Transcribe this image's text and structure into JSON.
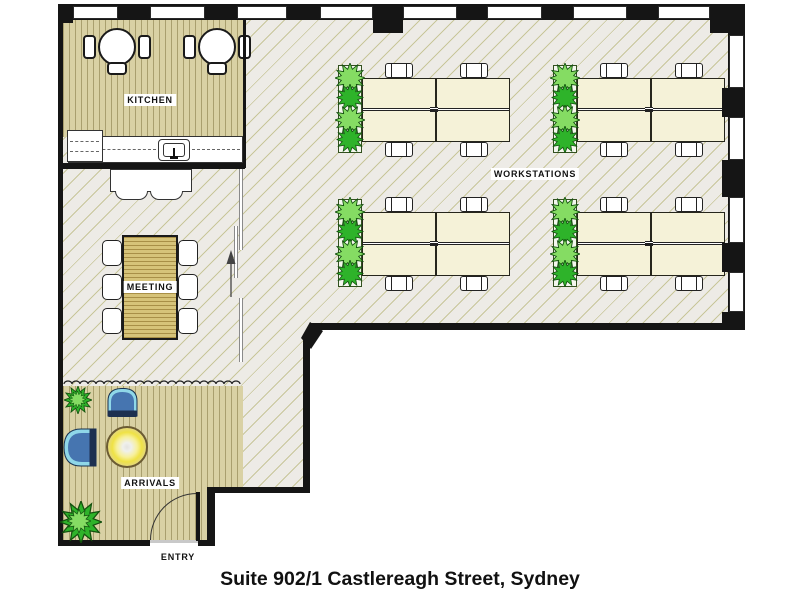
{
  "plan": {
    "caption": "Suite 902/1 Castlereagh Street, Sydney",
    "labels": {
      "kitchen": "KITCHEN",
      "meeting": "MEETING",
      "arrivals": "ARRIVALS",
      "workstations": "WORKSTATIONS",
      "entry": "ENTRY"
    },
    "colors": {
      "wall": "#151515",
      "floor_main": "#edebe6",
      "floor_hatch": "#c8c69a",
      "floor_timber": "#d9d1a4",
      "timber_stripe": "#a99f6e",
      "desk": "#f5f2d8",
      "meeting_table": "#d6c379",
      "plant_bright": "#2eb32a",
      "plant_light": "#85dc63",
      "chair_blue": "#4675b0",
      "chair_trim": "#8fd7e8",
      "chair_dark": "#1d3050",
      "lamp_yellow": "#efe245"
    }
  }
}
